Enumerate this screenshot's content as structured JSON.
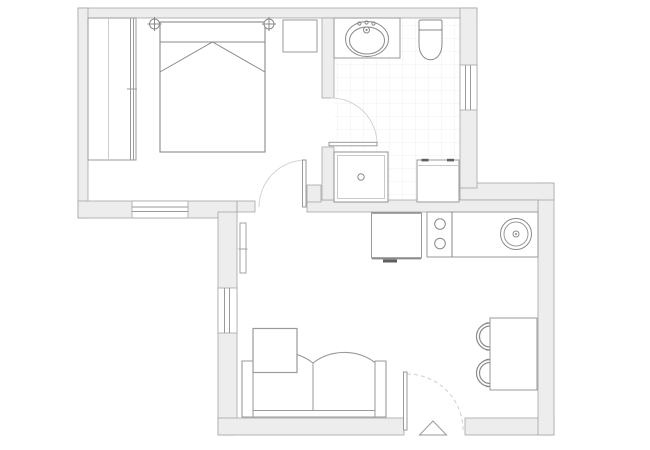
{
  "meta": {
    "title": "apartment-floor-plan",
    "document_type": "architectural-floor-plan",
    "canvas": {
      "width": 650,
      "height": 450
    },
    "visible_text": "none"
  },
  "palette": {
    "background": "#ffffff",
    "wall_fill": "#ededed",
    "wall_stroke": "#a6a6a6",
    "furniture_stroke": "#969696",
    "fixture_detail_stroke": "#8a8a8a",
    "light_line": "#c9c9c9",
    "door_swing_arc": "#d4d4d4",
    "tile_grid": "#f1f1f1",
    "dark_accent": "#5f5f5f"
  },
  "rooms": [
    {
      "id": "bedroom",
      "position": "top-left",
      "floor": "plain",
      "fixtures": [
        "wardrobe",
        "double-bed",
        "nightstand",
        "light-symbol",
        "light-symbol"
      ],
      "window_count": 1,
      "door": "bedroom-door"
    },
    {
      "id": "bathroom",
      "position": "top-right",
      "floor": "tiled",
      "fixtures": [
        "vanity-counter",
        "washbasin",
        "toilet",
        "shower",
        "washing-machine"
      ],
      "window_count": 1,
      "door": "bathroom-door"
    },
    {
      "id": "kitchen",
      "position": "middle-right",
      "floor": "plain",
      "fixtures": [
        "oven",
        "two-burner-cooktop",
        "round-kitchen-sink",
        "counter"
      ],
      "window_count": 0,
      "door": "open-plan"
    },
    {
      "id": "living-dining",
      "position": "bottom",
      "floor": "plain",
      "fixtures": [
        "radiator",
        "sofa",
        "coffee-table",
        "dining-table",
        "dining-chair",
        "dining-chair"
      ],
      "window_count": 1,
      "door": "entrance-door"
    }
  ],
  "doors": [
    {
      "id": "bedroom-door",
      "type": "hinged",
      "swing": "into-bedroom",
      "arc_style": "solid"
    },
    {
      "id": "bathroom-door",
      "type": "hinged",
      "swing": "into-bathroom",
      "arc_style": "solid"
    },
    {
      "id": "entrance-door",
      "type": "hinged",
      "swing": "inward",
      "arc_style": "dashed",
      "marker": "entrance-triangle"
    }
  ],
  "windows": [
    {
      "id": "bedroom-window",
      "wall": "bottom-exterior"
    },
    {
      "id": "bathroom-window",
      "wall": "right-exterior"
    },
    {
      "id": "living-room-window",
      "wall": "left-exterior"
    }
  ],
  "counts": {
    "burners": 2,
    "dining_chairs": 2,
    "light_symbols": 2
  }
}
